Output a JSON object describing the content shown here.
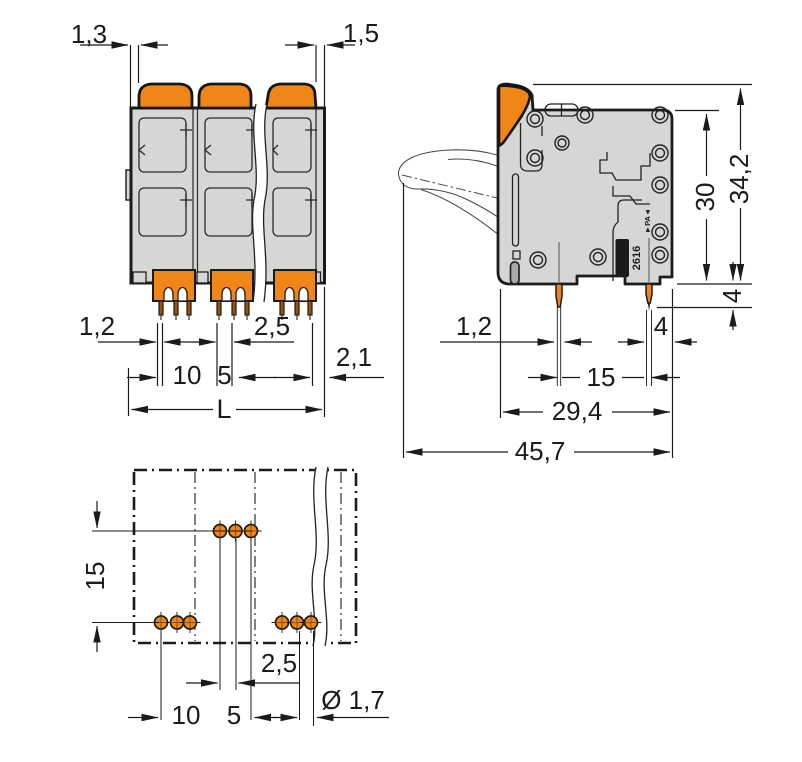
{
  "front_view": {
    "dim_lever_clearance_left": "1,3",
    "dim_lever_clearance_right": "1,5",
    "dim_pin_width": "1,2",
    "dim_pin_pitch": "2,5",
    "dim_pole_pitch": "10",
    "dim_group_span": "5",
    "dim_end_offset": "2,1",
    "dim_overall_length": "L"
  },
  "side_view": {
    "dim_pin_width": "1,2",
    "dim_pin_to_edge": "4",
    "dim_pin_spacing": "15",
    "dim_body_depth": "29,4",
    "dim_overall_depth": "45,7",
    "dim_body_height": "30",
    "dim_overall_height": "34,2",
    "dim_pin_length": "4",
    "marking_brand": "WAGO",
    "marking_series": "2616",
    "marking_material": "►PA◄"
  },
  "bottom_view": {
    "dim_row_spacing": "15",
    "dim_pad_pitch": "2,5",
    "dim_pole_pitch": "10",
    "dim_group_span": "5",
    "dim_hole_diameter": "Ø 1,7"
  },
  "colors": {
    "orange": "#F08617",
    "body_gray": "#D5D7D5",
    "line": "#1B1B1B"
  }
}
